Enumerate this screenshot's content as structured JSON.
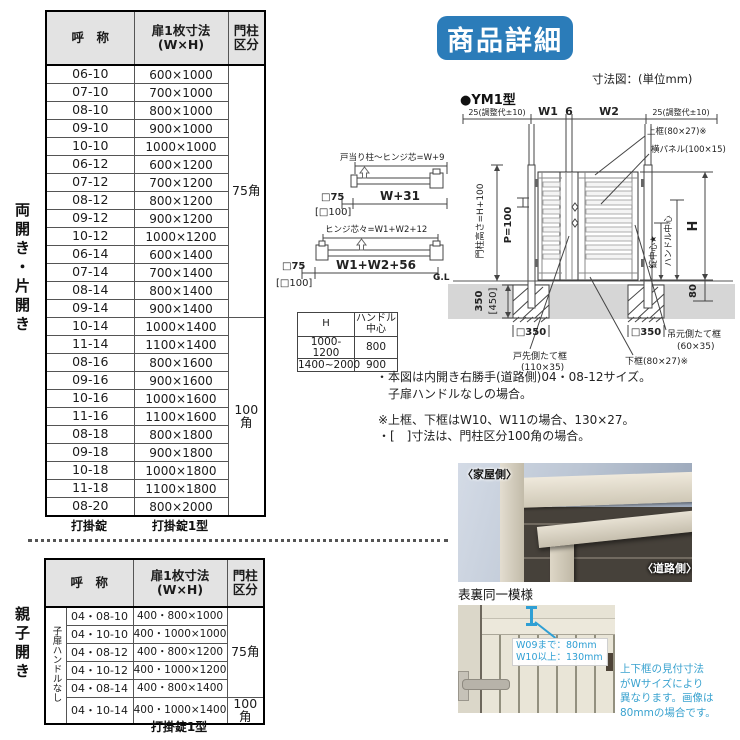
{
  "header": {
    "badge": "商品詳細",
    "scale_note": "寸法図：(単位mm)",
    "model": "●YM1型"
  },
  "table_main": {
    "side_label": "両開き・片開き",
    "col_name": "呼　称",
    "col_size_1": "扉1枚寸法",
    "col_size_2": "(W×H)",
    "col_post_1": "門柱",
    "col_post_2": "区分",
    "rows": [
      {
        "name": "06-10",
        "size": "600×1000"
      },
      {
        "name": "07-10",
        "size": "700×1000"
      },
      {
        "name": "08-10",
        "size": "800×1000"
      },
      {
        "name": "09-10",
        "size": "900×1000"
      },
      {
        "name": "10-10",
        "size": "1000×1000"
      },
      {
        "name": "06-12",
        "size": "600×1200"
      },
      {
        "name": "07-12",
        "size": "700×1200"
      },
      {
        "name": "08-12",
        "size": "800×1200"
      },
      {
        "name": "09-12",
        "size": "900×1200"
      },
      {
        "name": "10-12",
        "size": "1000×1200"
      },
      {
        "name": "06-14",
        "size": "600×1400"
      },
      {
        "name": "07-14",
        "size": "700×1400"
      },
      {
        "name": "08-14",
        "size": "800×1400"
      },
      {
        "name": "09-14",
        "size": "900×1400"
      },
      {
        "name": "10-14",
        "size": "1000×1400"
      },
      {
        "name": "11-14",
        "size": "1100×1400"
      },
      {
        "name": "08-16",
        "size": "800×1600"
      },
      {
        "name": "09-16",
        "size": "900×1600"
      },
      {
        "name": "10-16",
        "size": "1000×1600"
      },
      {
        "name": "11-16",
        "size": "1100×1600"
      },
      {
        "name": "08-18",
        "size": "800×1800"
      },
      {
        "name": "09-18",
        "size": "900×1800"
      },
      {
        "name": "10-18",
        "size": "1000×1800"
      },
      {
        "name": "11-18",
        "size": "1100×1800"
      },
      {
        "name": "08-20",
        "size": "800×2000"
      }
    ],
    "post_groups": [
      {
        "label": "75角"
      },
      {
        "label": "100角"
      }
    ],
    "footer_lock": "打掛錠",
    "footer_lock_type": "打掛錠1型"
  },
  "table_oyako": {
    "side_label": "親子開き",
    "sub_label": "子扉ハンドルなし",
    "col_name": "呼　称",
    "col_size_1": "扉1枚寸法",
    "col_size_2": "(W×H)",
    "col_post_1": "門柱",
    "col_post_2": "区分",
    "rows": [
      {
        "name": "04・08-10",
        "size": "400・800×1000"
      },
      {
        "name": "04・10-10",
        "size": "400・1000×1000"
      },
      {
        "name": "04・08-12",
        "size": "400・800×1200"
      },
      {
        "name": "04・10-12",
        "size": "400・1000×1200"
      },
      {
        "name": "04・08-14",
        "size": "400・800×1400"
      },
      {
        "name": "04・10-14",
        "size": "400・1000×1400"
      }
    ],
    "post_groups": [
      {
        "label": "75角"
      },
      {
        "label": "100角"
      }
    ],
    "footer_lock_type": "打掛錠1型"
  },
  "plan": {
    "hinge_top_label": "戸当り柱〜ヒンジ芯=W+9",
    "post1": "□75",
    "post1_alt": "[□100]",
    "w31": "W+31",
    "hinge_bottom_label": "ヒンジ芯々=W1+W2+12",
    "post2": "□75",
    "post2_alt": "[□100]",
    "w1w2": "W1+W2+56"
  },
  "handle_table": {
    "col_h": "H",
    "col_handle_1": "ハンドル",
    "col_handle_2": "中心",
    "rows": [
      {
        "h": "1000-1200",
        "c": "800"
      },
      {
        "h": "1400~2000",
        "c": "900"
      }
    ]
  },
  "elevation": {
    "adj_left": "25(調整代±10)",
    "w1": "W1",
    "gap": "6",
    "w2": "W2",
    "adj_right": "25(調整代±10)",
    "top_rail": "上框(80×27)※",
    "panel": "横パネル(100×15)",
    "post_height": "門柱高さ=H+100",
    "pitch": "P=100",
    "gl": "G.L",
    "depth": "350",
    "depth_alt": "[450]",
    "footing_left": "□350",
    "footing_right": "□350",
    "front_stile": "戸先側たて框",
    "front_stile_size": "(110×35)",
    "bottom_rail": "下框(80×27)※",
    "hinge_stile": "吊元側たて框",
    "hinge_stile_size": "(60×35)",
    "lock_center": "錠中心★",
    "handle_center": "ハンドル中心",
    "height": "H",
    "clearance": "80"
  },
  "notes": {
    "line1": "・本図は内開き右勝手(道路側)04・08-12サイズ。",
    "line2": "子扉ハンドルなしの場合。",
    "line3": "※上框、下框はW10、W11の場合、130×27。",
    "line4": "・[　]寸法は、門柱区分100角の場合。"
  },
  "photo1": {
    "label_house": "〈家屋側〉",
    "label_road": "〈道路側〉",
    "caption": "表裏同一模様"
  },
  "photo2": {
    "callout_1": "W09まで：80mm",
    "callout_2": "W10以上：130mm",
    "note_1": "上下框の見付寸法",
    "note_2": "がWサイズにより",
    "note_3": "異なります。画像は",
    "note_4": "80mmの場合です。"
  },
  "colors": {
    "badge_blue": "#2b7cb9",
    "accent_blue": "#39a2cf",
    "table_header": "#e3e3e3"
  }
}
